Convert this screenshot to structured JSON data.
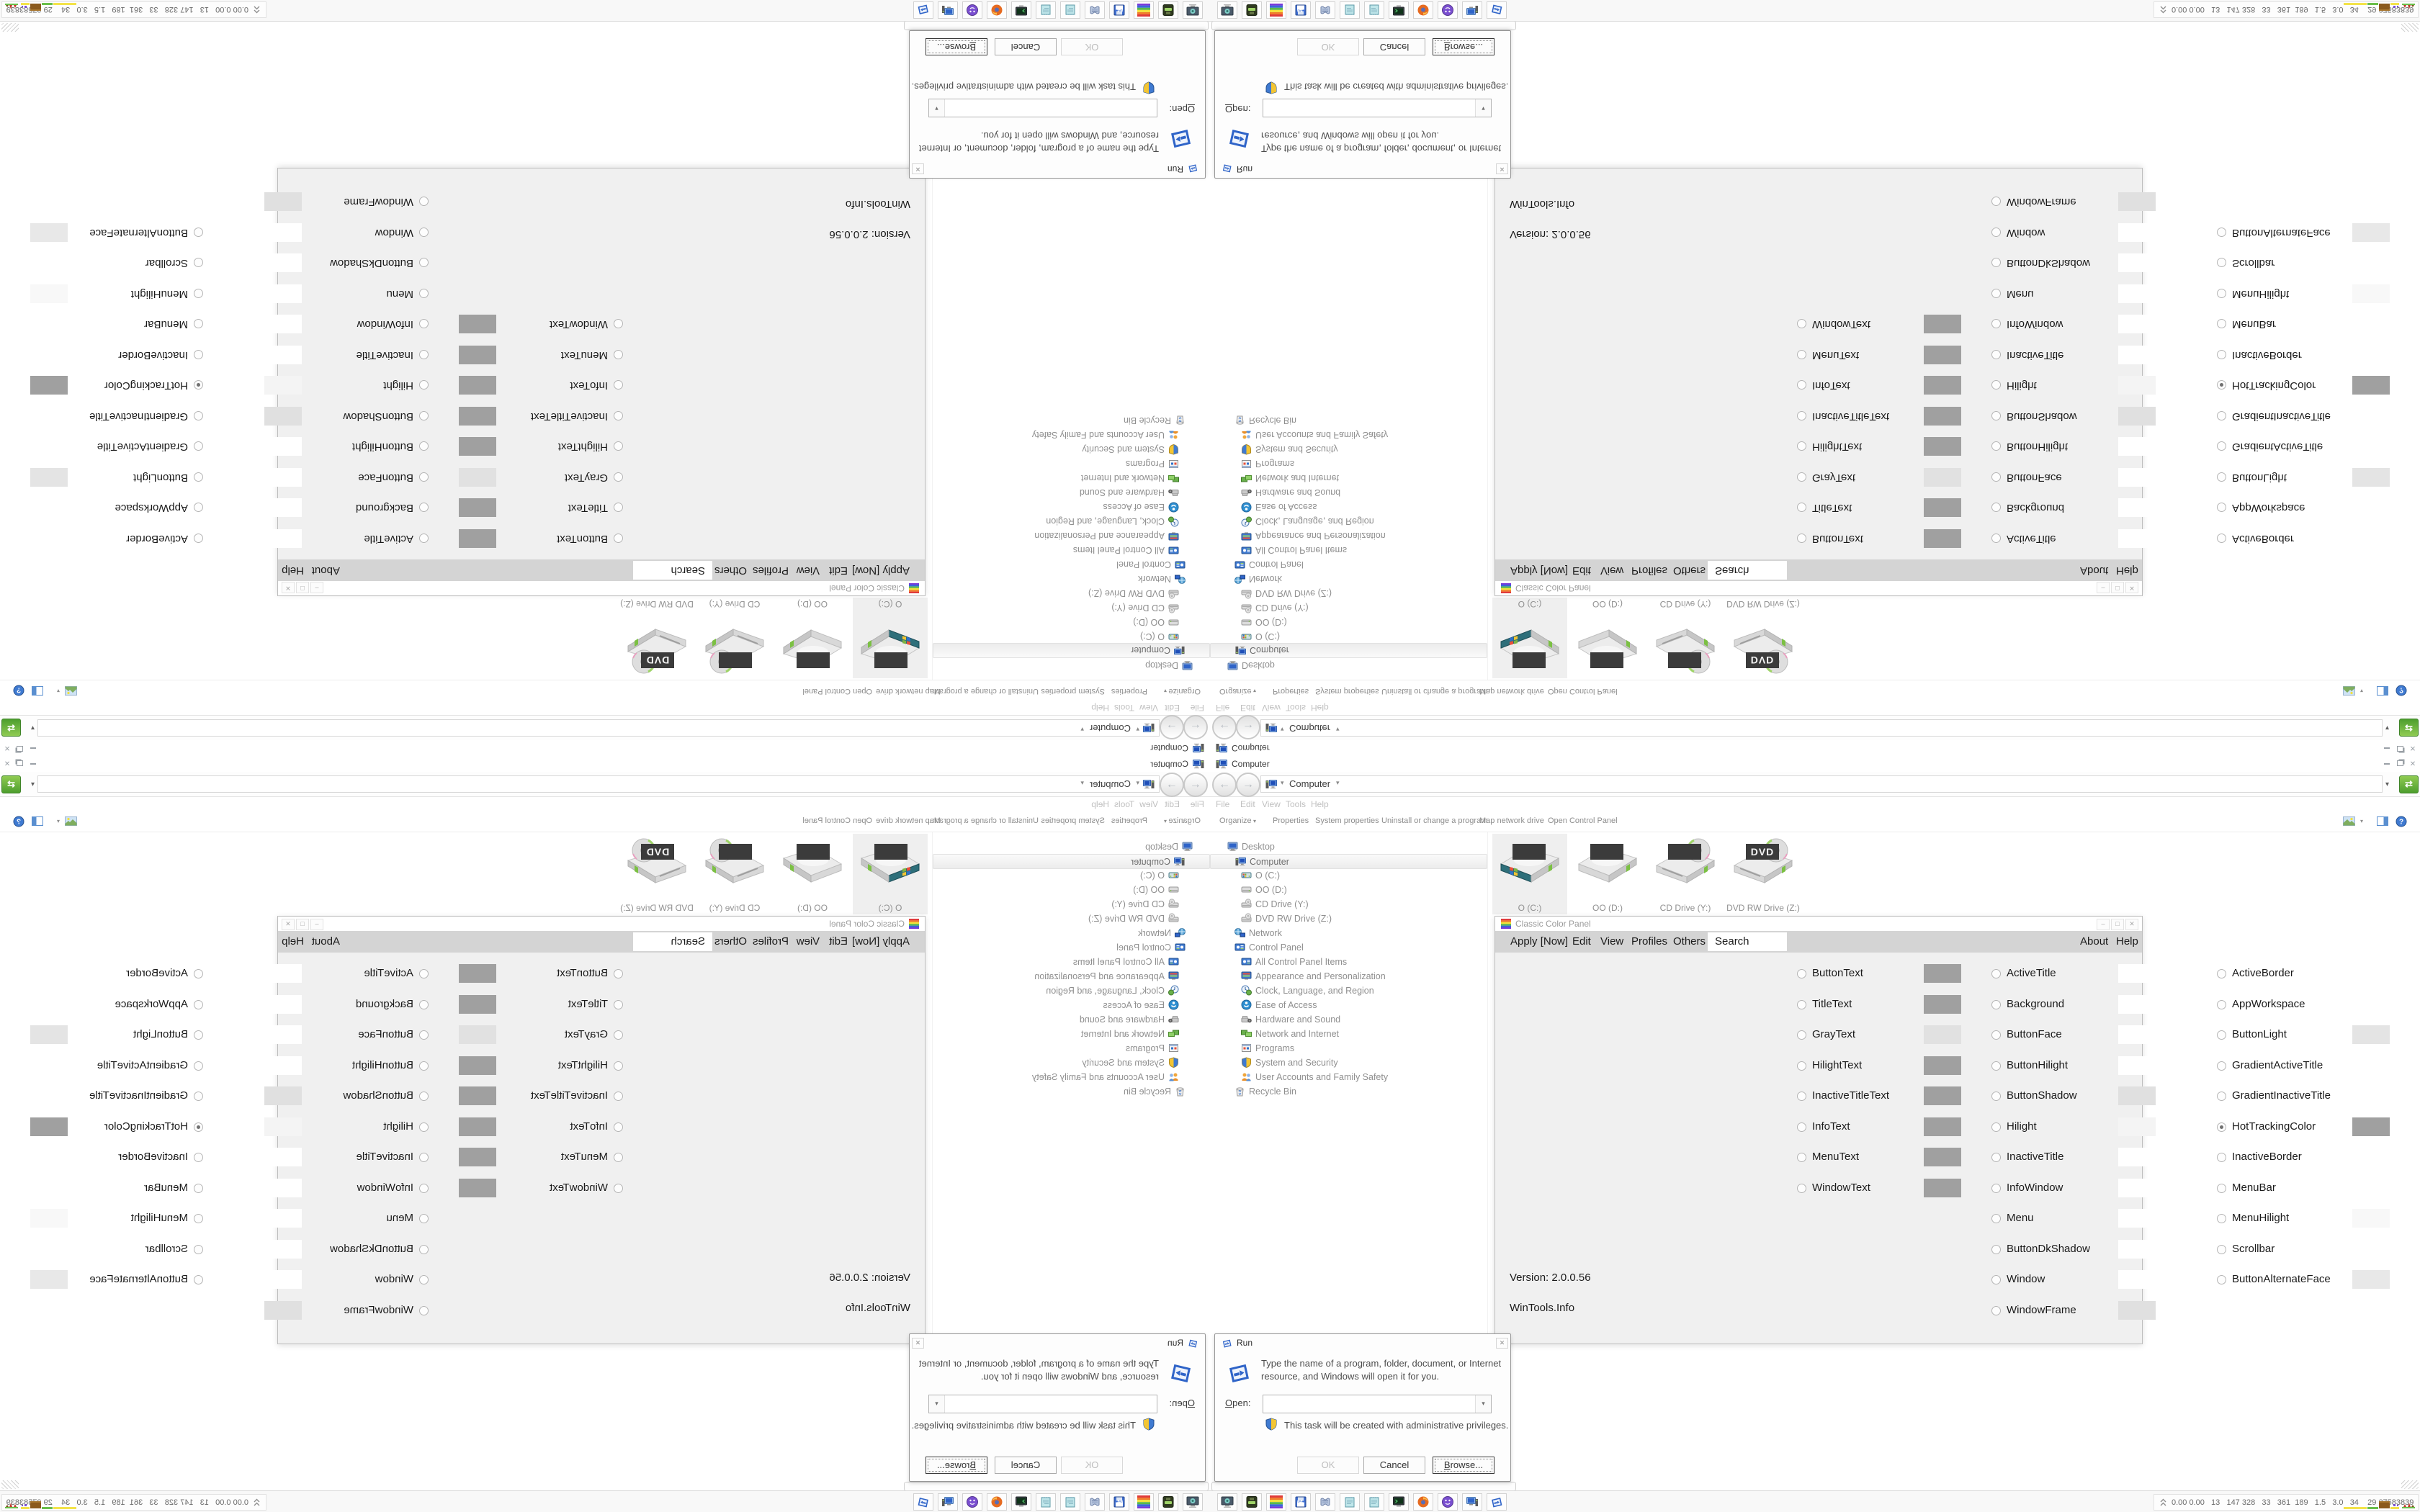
{
  "icons": {
    "dropdown": "▾",
    "back": "←",
    "forward": "→",
    "close": "✕",
    "refresh": "⇄"
  },
  "explorer": {
    "title": "Computer",
    "breadcrumb": "Computer",
    "menus": [
      "File",
      "Edit",
      "View",
      "Tools",
      "Help"
    ],
    "toolbar": [
      "Organize",
      "Properties",
      "System properties",
      "Uninstall or change a program",
      "Map network drive",
      "Open Control Panel"
    ],
    "tree": [
      {
        "label": "Desktop",
        "depth": 1,
        "icon": "monitor",
        "selected": false
      },
      {
        "label": "Computer",
        "depth": 2,
        "icon": "computer",
        "selected": true
      },
      {
        "label": "O (C:)",
        "depth": 3,
        "icon": "drive-win",
        "selected": false
      },
      {
        "label": "OO (D:)",
        "depth": 3,
        "icon": "drive",
        "selected": false
      },
      {
        "label": "CD Drive (Y:)",
        "depth": 3,
        "icon": "disc-drive",
        "selected": false
      },
      {
        "label": "DVD RW Drive (Z:)",
        "depth": 3,
        "icon": "disc-drive",
        "selected": false
      },
      {
        "label": "Network",
        "depth": 2,
        "icon": "network",
        "selected": false
      },
      {
        "label": "Control Panel",
        "depth": 2,
        "icon": "control-panel",
        "selected": false
      },
      {
        "label": "All Control Panel Items",
        "depth": 3,
        "icon": "control-panel",
        "selected": false
      },
      {
        "label": "Appearance and Personalization",
        "depth": 3,
        "icon": "appearance",
        "selected": false
      },
      {
        "label": "Clock, Language, and Region",
        "depth": 3,
        "icon": "clock",
        "selected": false
      },
      {
        "label": "Ease of Access",
        "depth": 3,
        "icon": "ease",
        "selected": false
      },
      {
        "label": "Hardware and Sound",
        "depth": 3,
        "icon": "hardware",
        "selected": false
      },
      {
        "label": "Network and Internet",
        "depth": 3,
        "icon": "net",
        "selected": false
      },
      {
        "label": "Programs",
        "depth": 3,
        "icon": "programs",
        "selected": false
      },
      {
        "label": "System and Security",
        "depth": 3,
        "icon": "security",
        "selected": false
      },
      {
        "label": "User Accounts and Family Safety",
        "depth": 3,
        "icon": "users",
        "selected": false
      },
      {
        "label": "Recycle Bin",
        "depth": 2,
        "icon": "recycle",
        "selected": false
      }
    ],
    "drives": [
      {
        "label": "O (C:)",
        "icon": "hdd-win",
        "selected": true,
        "badge": ""
      },
      {
        "label": "OO (D:)",
        "icon": "hdd",
        "selected": false,
        "badge": ""
      },
      {
        "label": "CD Drive (Y:)",
        "icon": "hdd-disc",
        "selected": false,
        "badge": ""
      },
      {
        "label": "DVD RW Drive (Z:)",
        "icon": "hdd-disc",
        "selected": false,
        "badge": "DVD"
      }
    ]
  },
  "ccp": {
    "title": "Classic Color Panel",
    "menu": {
      "apply": "Apply [Now]",
      "edit": "Edit",
      "view": "View",
      "profiles": "Profiles",
      "others": "Others",
      "search": "Search",
      "about": "About",
      "help": "Help"
    },
    "col1": [
      {
        "label": "ButtonText",
        "color": "#a0a0a0",
        "selected": false
      },
      {
        "label": "TitleText",
        "color": "#a0a0a0",
        "selected": false
      },
      {
        "label": "GrayText",
        "color": "#e1e1e1",
        "selected": false
      },
      {
        "label": "HilightText",
        "color": "#a0a0a0",
        "selected": false
      },
      {
        "label": "InactiveTitleText",
        "color": "#a0a0a0",
        "selected": false
      },
      {
        "label": "InfoText",
        "color": "#a0a0a0",
        "selected": false
      },
      {
        "label": "MenuText",
        "color": "#a0a0a0",
        "selected": false
      },
      {
        "label": "WindowText",
        "color": "#a0a0a0",
        "selected": false
      }
    ],
    "col2": [
      {
        "label": "ActiveTitle",
        "color": "#ffffff",
        "selected": false
      },
      {
        "label": "Background",
        "color": "#ffffff",
        "selected": false
      },
      {
        "label": "ButtonFace",
        "color": "#ffffff",
        "selected": false
      },
      {
        "label": "ButtonHilight",
        "color": "#ffffff",
        "selected": false
      },
      {
        "label": "ButtonShadow",
        "color": "#e0e0e0",
        "selected": false
      },
      {
        "label": "Hilight",
        "color": "#f4f4f4",
        "selected": false
      },
      {
        "label": "InactiveTitle",
        "color": "#ffffff",
        "selected": false
      },
      {
        "label": "InfoWindow",
        "color": "#ffffff",
        "selected": false
      },
      {
        "label": "Menu",
        "color": "#ffffff",
        "selected": false
      },
      {
        "label": "ButtonDkShadow",
        "color": "#ffffff",
        "selected": false
      },
      {
        "label": "Window",
        "color": "#ffffff",
        "selected": false
      },
      {
        "label": "WindowFrame",
        "color": "#e0e0e0",
        "selected": false
      }
    ],
    "col3": [
      {
        "label": "ActiveBorder",
        "color": "#ffffff",
        "selected": false
      },
      {
        "label": "AppWorkspace",
        "color": "#ffffff",
        "selected": false
      },
      {
        "label": "ButtonLight",
        "color": "#e4e4e4",
        "selected": false
      },
      {
        "label": "GradientActiveTitle",
        "color": "#ffffff",
        "selected": false
      },
      {
        "label": "GradientInactiveTitle",
        "color": "#ffffff",
        "selected": false
      },
      {
        "label": "HotTrackingColor",
        "color": "#a0a0a0",
        "selected": true
      },
      {
        "label": "InactiveBorder",
        "color": "#ffffff",
        "selected": false
      },
      {
        "label": "MenuBar",
        "color": "#ffffff",
        "selected": false
      },
      {
        "label": "MenuHilight",
        "color": "#f8f8f8",
        "selected": false
      },
      {
        "label": "Scrollbar",
        "color": "#ffffff",
        "selected": false
      },
      {
        "label": "ButtonAlternateFace",
        "color": "#e8e8e8",
        "selected": false
      }
    ],
    "version": "Version: 2.0.0.56",
    "credit": "WinTools.Info"
  },
  "run": {
    "title": "Run",
    "message_line1": "Type the name of a program, folder, document, or Internet",
    "message_line2": "resource, and Windows will open it for you.",
    "open_label": "Open:",
    "open_value": "",
    "admin_note": "This task will be created with administrative privileges.",
    "ok": "OK",
    "cancel": "Cancel",
    "browse": "Browse..."
  },
  "taskbar": {
    "buttons": [
      {
        "icon": "system-settings",
        "badge": ""
      },
      {
        "icon": "disk-utility",
        "badge": ""
      },
      {
        "icon": "classic-color-panel",
        "badge": ""
      },
      {
        "icon": "floppy",
        "badge": "64"
      },
      {
        "icon": "print-scroll",
        "badge": ""
      },
      {
        "icon": "notepad",
        "badge": ""
      },
      {
        "icon": "notepad",
        "badge": ""
      },
      {
        "icon": "console-monitor",
        "badge": ""
      },
      {
        "icon": "firefox",
        "badge": ""
      },
      {
        "icon": "purple-orb",
        "badge": ""
      },
      {
        "icon": "computer-blue",
        "badge": ""
      },
      {
        "icon": "run-window",
        "badge": ""
      }
    ],
    "tray_values": "0.00 0.00   13   147 328   33   361  189   1.5   3.0   34    29 27583839"
  }
}
